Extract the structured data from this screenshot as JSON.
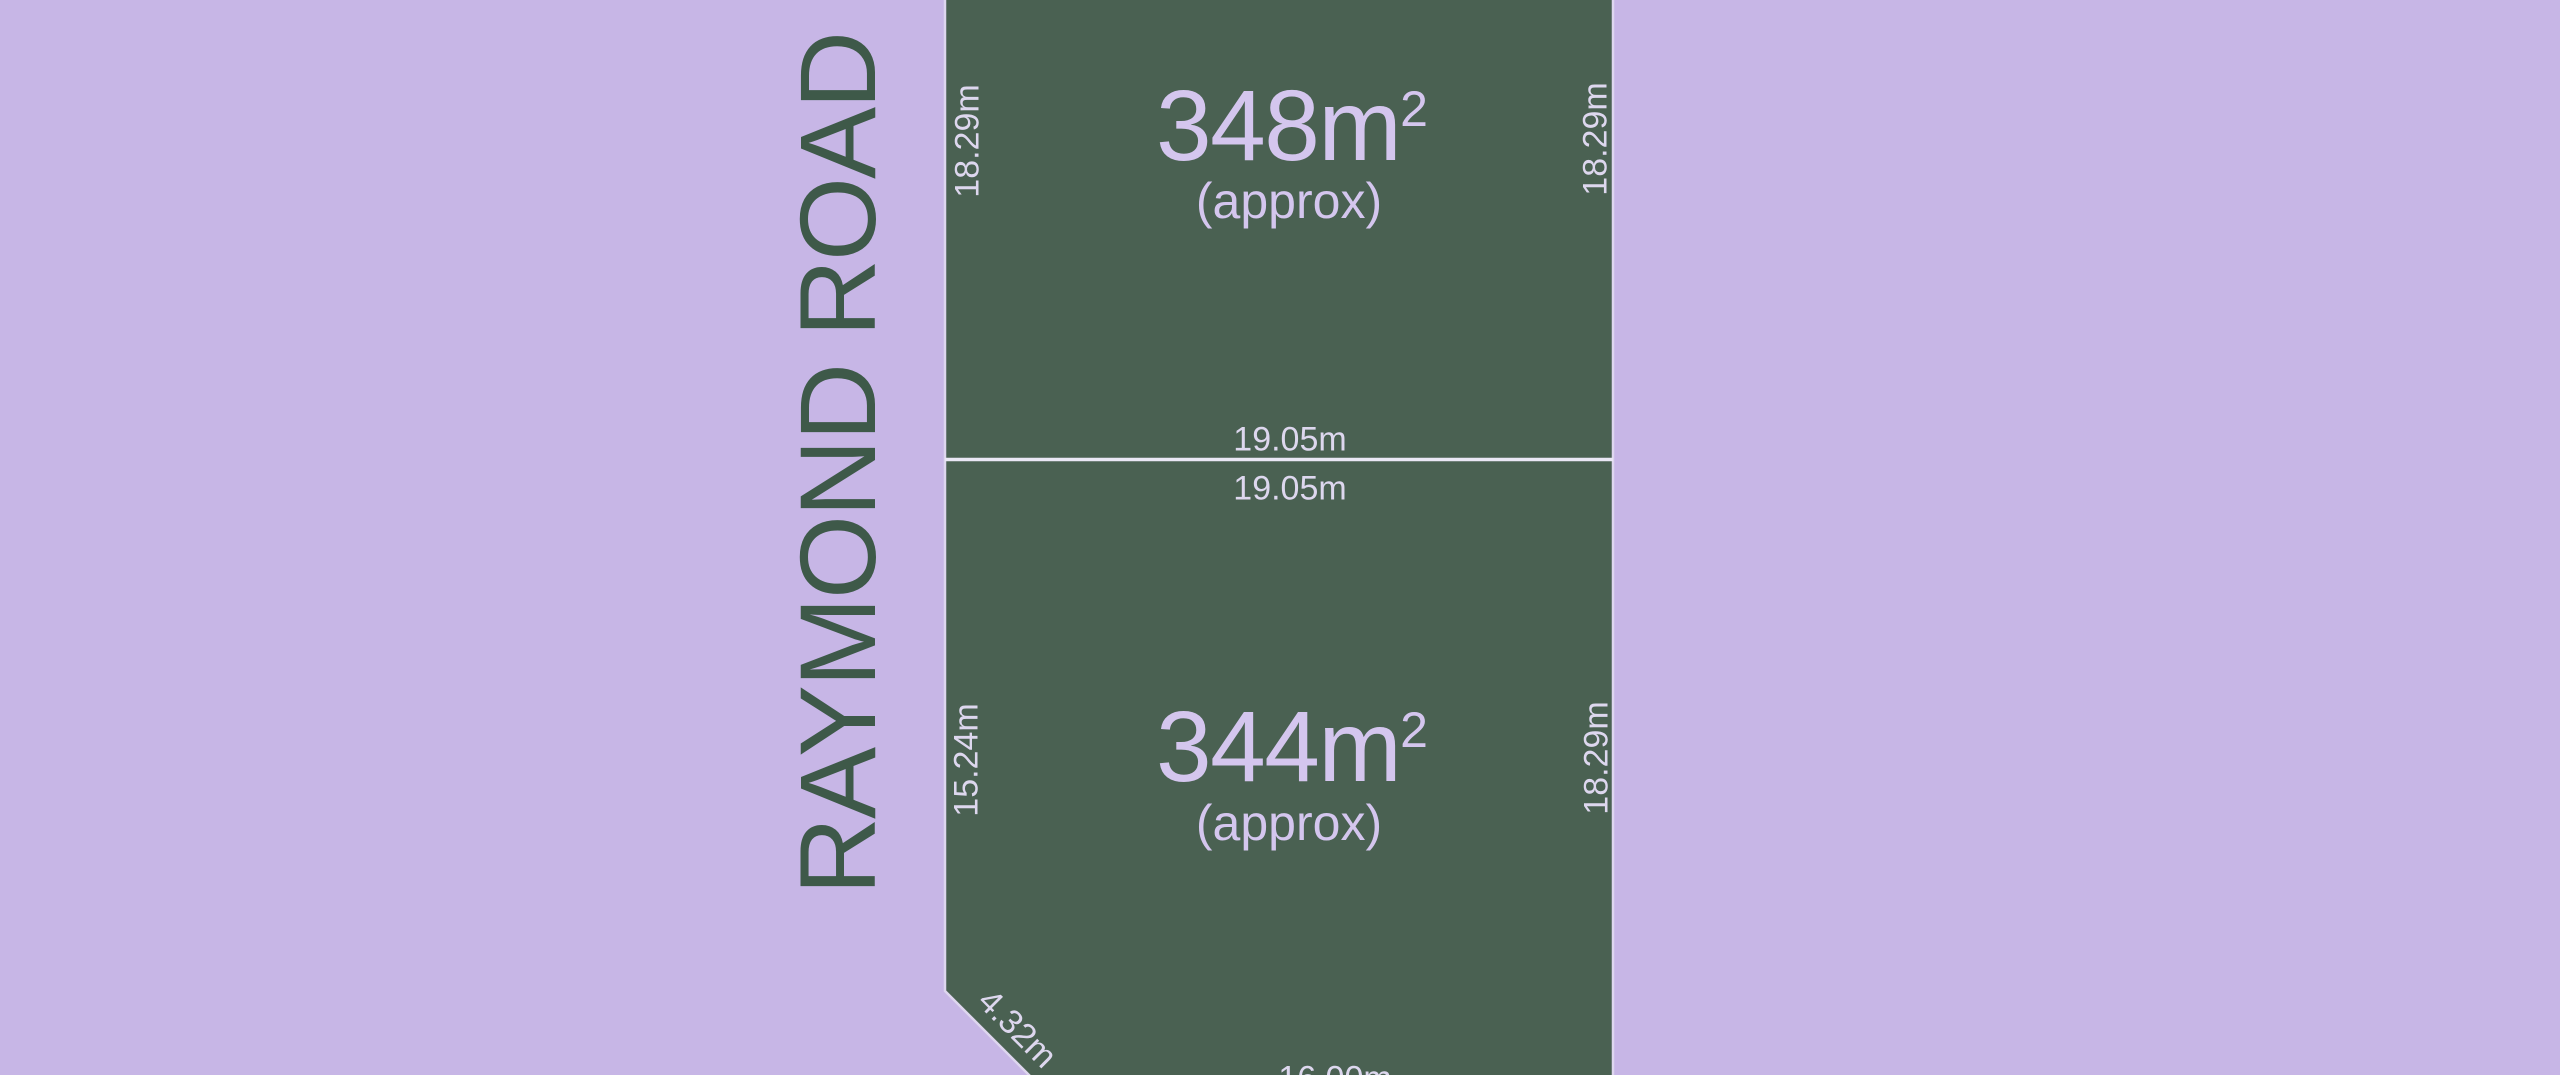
{
  "plan": {
    "road_name": "RAYMOND ROAD",
    "lots": [
      {
        "name": "lot-1",
        "area_value": "348m",
        "area_exponent": "2",
        "area_qualifier": "(approx)",
        "dim_left": "18.29m",
        "dim_right": "18.29m",
        "dim_bottom_above_divider": "19.05m"
      },
      {
        "name": "lot-2",
        "area_value": "344m",
        "area_exponent": "2",
        "area_qualifier": "(approx)",
        "dim_top_below_divider": "19.05m",
        "dim_left": "15.24m",
        "dim_right": "18.29m",
        "dim_diagonal": "4.32m",
        "dim_bottom": "16.00m"
      }
    ],
    "colors": {
      "background": "#c7b6e6",
      "parcel_fill": "#4a6152",
      "parcel_stroke": "#ded6ef",
      "divider_line": "#eae7f5",
      "road_text": "#3e5949",
      "area_text": "#d4c6ee",
      "dimension_text": "#ddd7ee"
    }
  }
}
